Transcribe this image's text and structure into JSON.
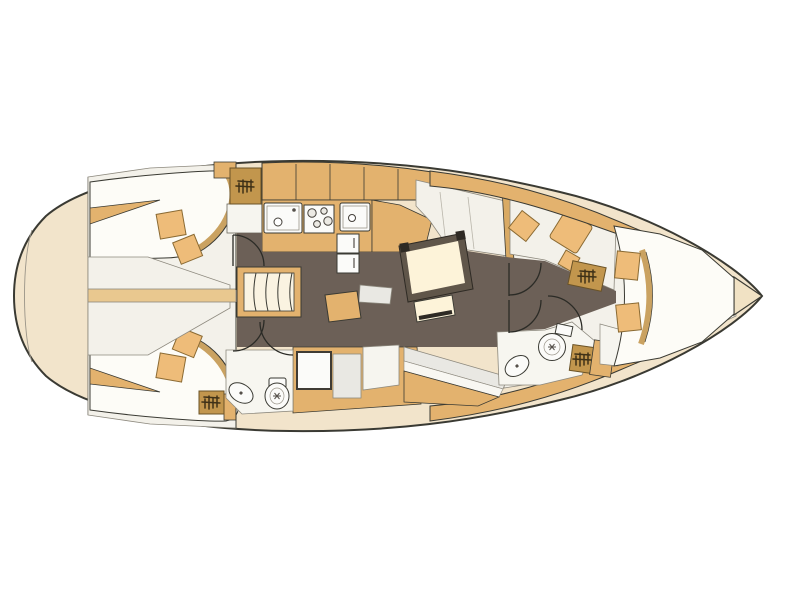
{
  "figure": {
    "kind": "sailing-yacht-interior-floor-plan",
    "orientation": "bow-right-stern-left",
    "canvas": {
      "width": 800,
      "height": 600
    },
    "visible_text": "none"
  },
  "palette": {
    "background": "#ffffff",
    "line": "#3a3a33",
    "deck_beige": "#f2e4cb",
    "bow_tip": "#f1e2c4",
    "interior_white": "#f3f1ea",
    "mattress_white": "#fdfcf7",
    "seat_gray": "#e9e8e3",
    "wood_tan": "#e3b26e",
    "wood_tan_light": "#e9c88f",
    "cushion_tan": "#eebc79",
    "hatch_wood_dark": "#c2964d",
    "floor_dark": "#6c6057",
    "table_cream": "#fdf3d9",
    "table_frame": "#60564a",
    "fixture_white": "#fbfbf9",
    "steps_cream": "#faf3e1"
  },
  "rooms": [
    {
      "id": "stern-transom",
      "side": "aft"
    },
    {
      "id": "aft-cabin-port",
      "features": [
        "double-bed",
        "two-pillows",
        "hull-wedge-shelf"
      ]
    },
    {
      "id": "aft-cabin-starboard",
      "features": [
        "double-bed",
        "two-pillows",
        "wet-locker"
      ]
    },
    {
      "id": "engine-compartment",
      "features": [
        "center-beam"
      ]
    },
    {
      "id": "galley",
      "features": [
        "upper-cabinets",
        "double-sink",
        "stove-4-burners",
        "second-sink",
        "fridge-2-drawers",
        "wet-locker",
        "counter"
      ]
    },
    {
      "id": "companionway",
      "features": [
        "curved-stairs",
        "doors"
      ]
    },
    {
      "id": "aft-head",
      "features": [
        "toilet",
        "washbasin",
        "shower-pan"
      ]
    },
    {
      "id": "salon",
      "features": [
        "dining-table",
        "bench",
        "u-settee",
        "long-settee",
        "nav-table",
        "nav-seat"
      ]
    },
    {
      "id": "forward-head",
      "features": [
        "toilet",
        "washbasin",
        "shower-grate",
        "cabinet"
      ]
    },
    {
      "id": "forward-cabin",
      "features": [
        "v-berth-bed",
        "two-pillows",
        "seat-cushions",
        "floor-hatch"
      ]
    },
    {
      "id": "bow-locker",
      "side": "forward"
    }
  ],
  "door_count": 6,
  "hatched_locker_count": 4
}
